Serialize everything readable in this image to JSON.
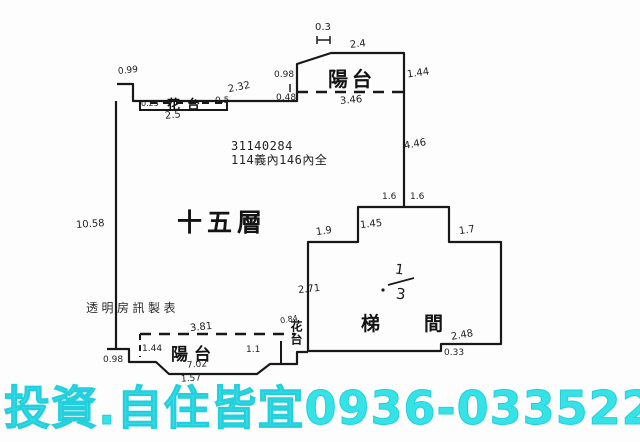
{
  "plan": {
    "registry_number": "31140284",
    "area_note": "114義內146內全",
    "floor_label": "十五層",
    "stair_label": "梯間",
    "watermark": "透明房訊製表",
    "balcony_top_label": "陽台",
    "balcony_bottom_label": "陽台",
    "flower_box_top_label": "花台",
    "flower_box_bottom_label": "花台",
    "stair_fraction": {
      "numerator": "1",
      "denominator": "3"
    },
    "line_color": "#181818",
    "measurements": [
      {
        "text": "0.3",
        "x": 315,
        "y": 22,
        "fs": 10,
        "rot": 0
      },
      {
        "text": "2.4",
        "x": 350,
        "y": 39,
        "fs": 10,
        "rot": -6
      },
      {
        "text": "1.44",
        "x": 407,
        "y": 68,
        "fs": 10,
        "rot": -8
      },
      {
        "text": "3.46",
        "x": 340,
        "y": 95,
        "fs": 10,
        "rot": -5
      },
      {
        "text": "4.46",
        "x": 404,
        "y": 139,
        "fs": 10,
        "rot": -10
      },
      {
        "text": "0.98",
        "x": 274,
        "y": 70,
        "fs": 9,
        "rot": 0
      },
      {
        "text": "0.48",
        "x": 276,
        "y": 93,
        "fs": 9,
        "rot": 0
      },
      {
        "text": "2.32",
        "x": 228,
        "y": 82,
        "fs": 10,
        "rot": -12
      },
      {
        "text": "0.99",
        "x": 118,
        "y": 66,
        "fs": 9,
        "rot": -6
      },
      {
        "text": "0.25",
        "x": 141,
        "y": 99,
        "fs": 8,
        "rot": 0
      },
      {
        "text": "0.5",
        "x": 215,
        "y": 96,
        "fs": 9,
        "rot": 0
      },
      {
        "text": "2.5",
        "x": 165,
        "y": 110,
        "fs": 10,
        "rot": -6
      },
      {
        "text": "10.58",
        "x": 76,
        "y": 219,
        "fs": 10,
        "rot": -4
      },
      {
        "text": "1.6",
        "x": 382,
        "y": 192,
        "fs": 9,
        "rot": 0
      },
      {
        "text": "1.6",
        "x": 410,
        "y": 192,
        "fs": 9,
        "rot": 0
      },
      {
        "text": "1.45",
        "x": 360,
        "y": 219,
        "fs": 10,
        "rot": -6
      },
      {
        "text": "1.9",
        "x": 316,
        "y": 226,
        "fs": 10,
        "rot": -8
      },
      {
        "text": "1.7",
        "x": 459,
        "y": 225,
        "fs": 10,
        "rot": -8
      },
      {
        "text": "2.71",
        "x": 298,
        "y": 284,
        "fs": 10,
        "rot": -6
      },
      {
        "text": "2.48",
        "x": 451,
        "y": 330,
        "fs": 10,
        "rot": -10
      },
      {
        "text": "0.33",
        "x": 444,
        "y": 348,
        "fs": 9,
        "rot": 0
      },
      {
        "text": "3.81",
        "x": 190,
        "y": 322,
        "fs": 10,
        "rot": -6
      },
      {
        "text": "1.44",
        "x": 142,
        "y": 344,
        "fs": 9,
        "rot": 0
      },
      {
        "text": "0.98",
        "x": 103,
        "y": 355,
        "fs": 9,
        "rot": 0
      },
      {
        "text": "7.02",
        "x": 187,
        "y": 360,
        "fs": 9,
        "rot": -4
      },
      {
        "text": "1.57",
        "x": 181,
        "y": 374,
        "fs": 9,
        "rot": -4
      },
      {
        "text": "0.84",
        "x": 280,
        "y": 315,
        "fs": 8,
        "rot": -10
      },
      {
        "text": "1.1",
        "x": 246,
        "y": 345,
        "fs": 9,
        "rot": 0
      }
    ]
  },
  "footer": {
    "ad_text": "投資.自住皆宜",
    "phone": "0936-033522",
    "color": "#35e2e6",
    "stroke_color": "#23cfdd"
  }
}
